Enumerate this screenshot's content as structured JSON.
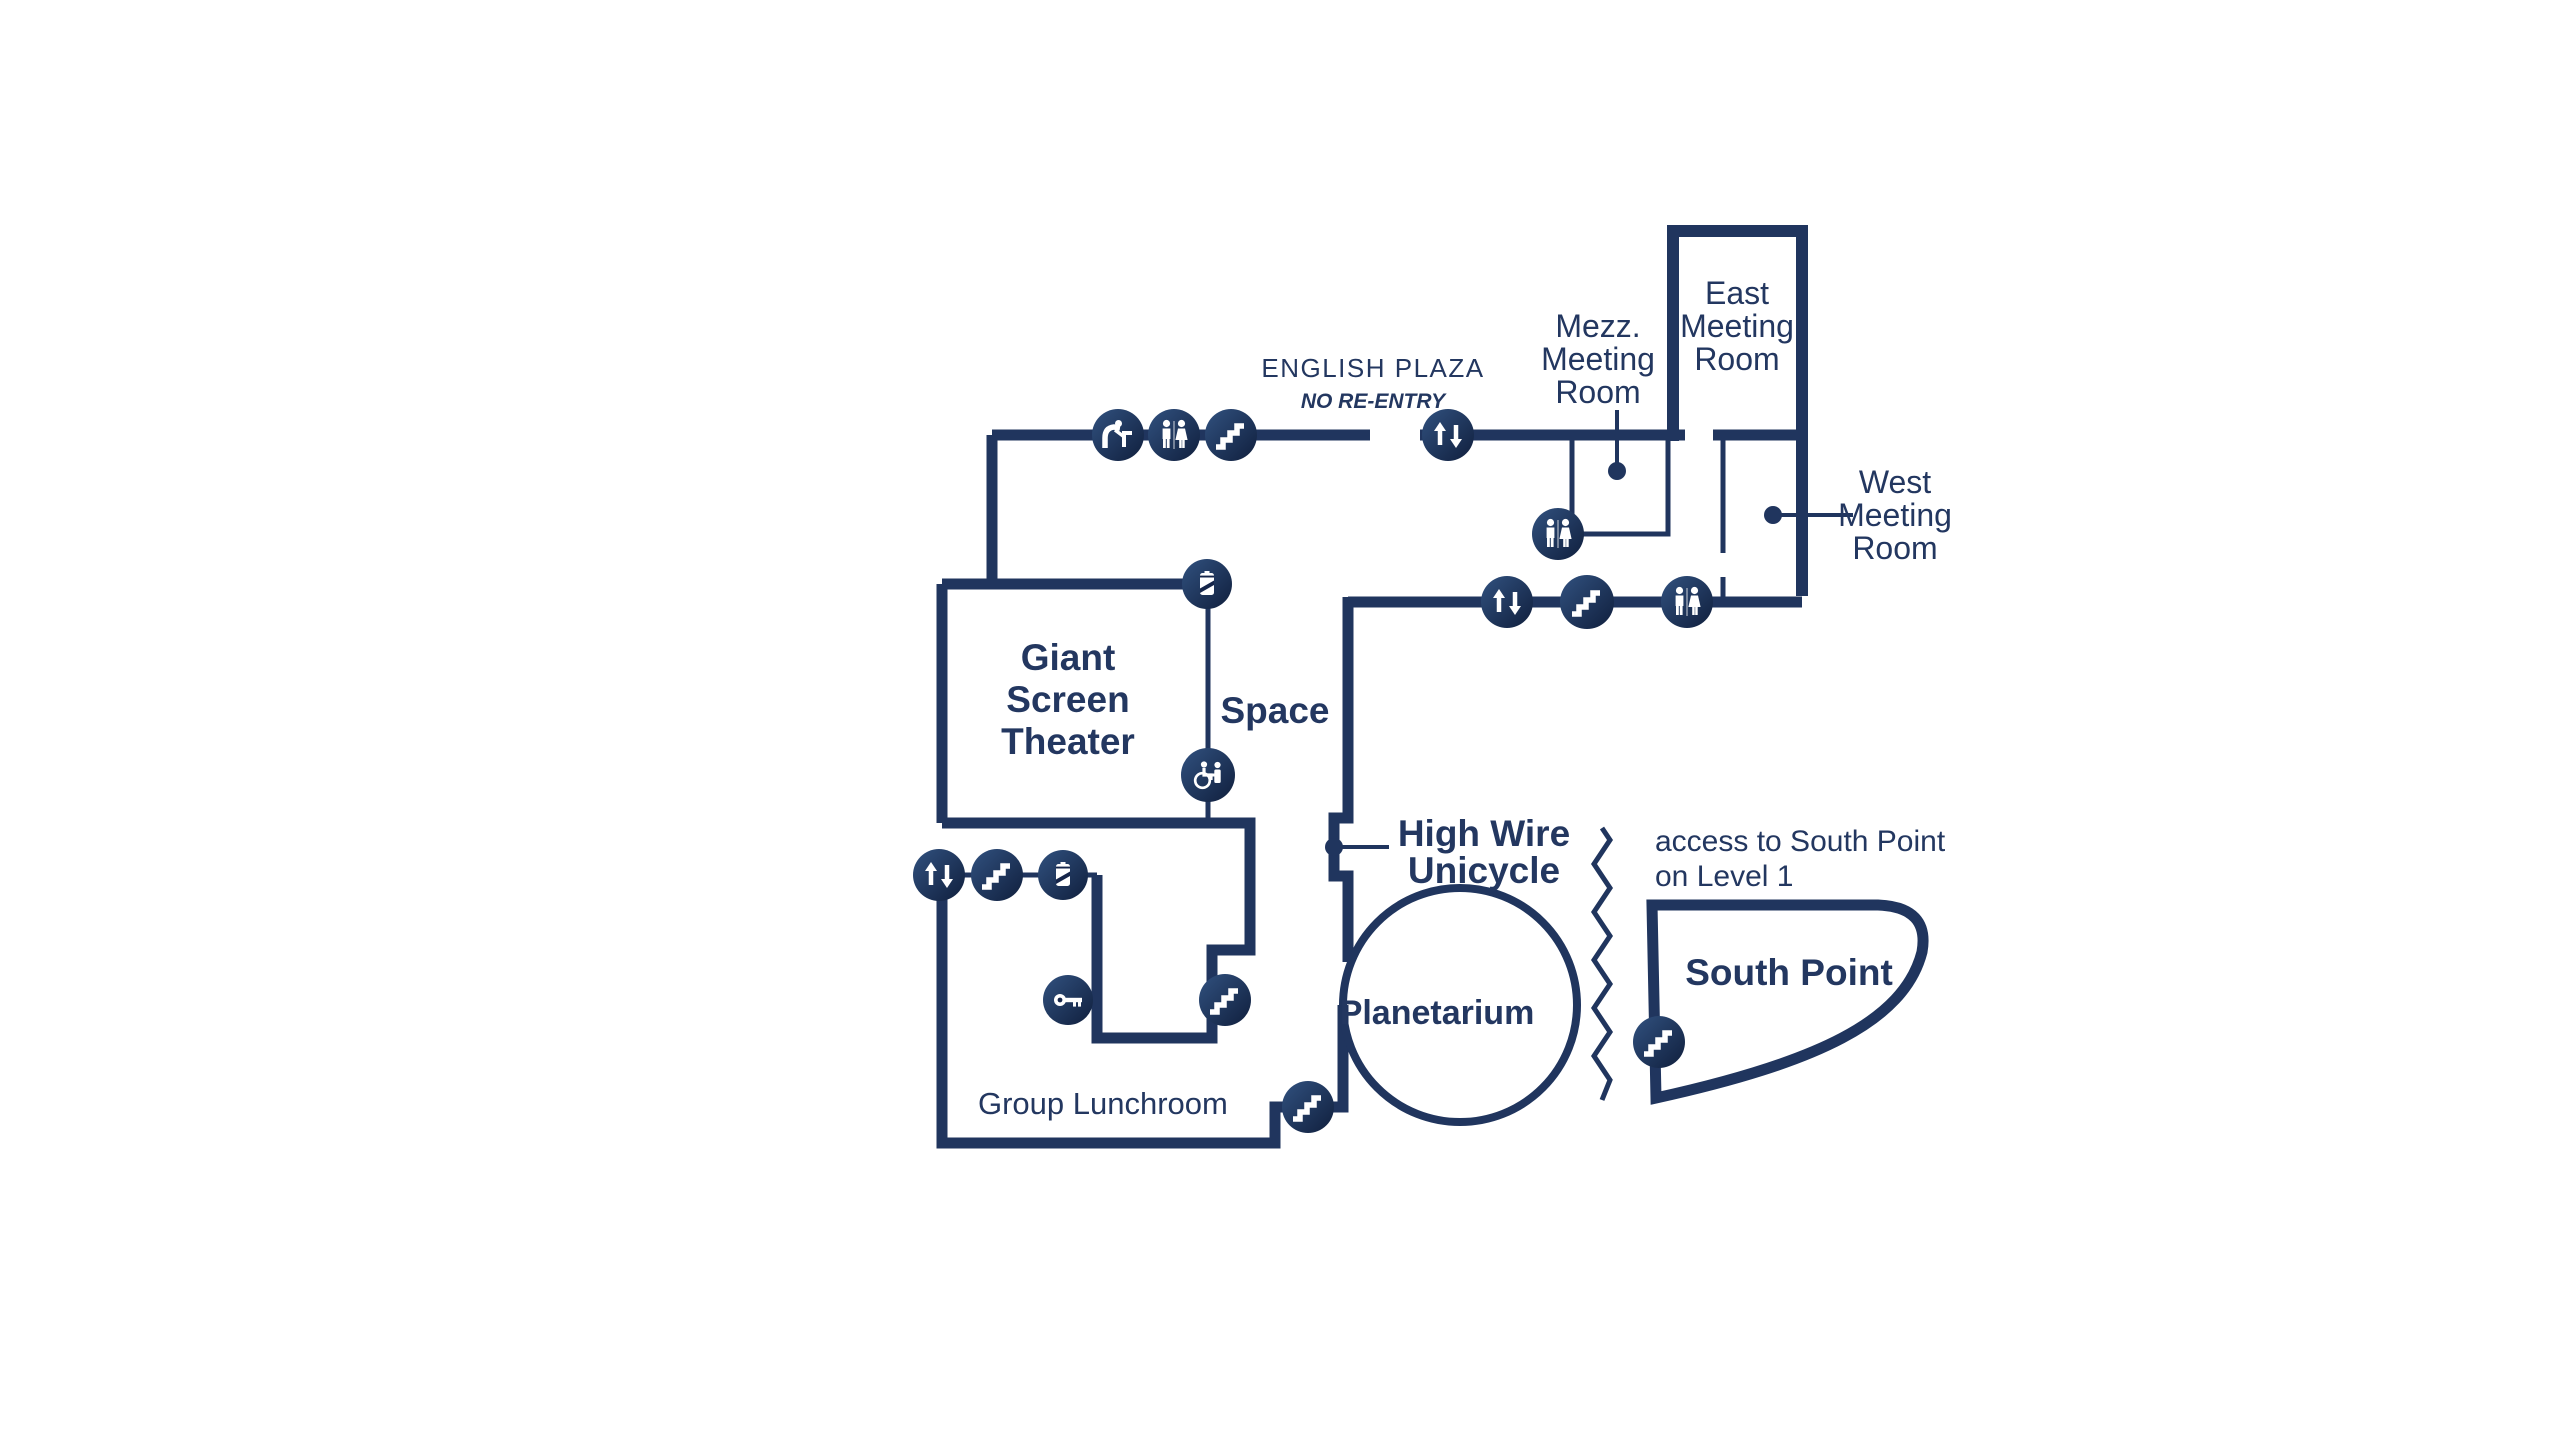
{
  "map": {
    "colors": {
      "navy_wall": "#20355e",
      "navy_text": "#233760",
      "icon_dark": "#101f3d",
      "icon_light": "#31517f",
      "background": "#ffffff"
    },
    "labels": {
      "english_plaza": "ENGLISH PLAZA",
      "no_reentry": "NO RE-ENTRY",
      "mezz_meeting_room": [
        "Mezz.",
        "Meeting",
        "Room"
      ],
      "east_meeting_room": [
        "East",
        "Meeting",
        "Room"
      ],
      "west_meeting_room": [
        "West",
        "Meeting",
        "Room"
      ],
      "giant_screen_theater": [
        "Giant",
        "Screen",
        "Theater"
      ],
      "space": "Space",
      "high_wire_unicycle": [
        "High Wire",
        "Unicycle"
      ],
      "planetarium": "Planetarium",
      "south_point": "South Point",
      "access_note": [
        "access to South Point",
        "on Level 1"
      ],
      "group_lunchroom": "Group Lunchroom"
    },
    "icon_types": [
      "elevator",
      "stairs",
      "restroom",
      "drinking-fountain",
      "vending",
      "accessible-family-restroom",
      "key-lockers"
    ]
  }
}
